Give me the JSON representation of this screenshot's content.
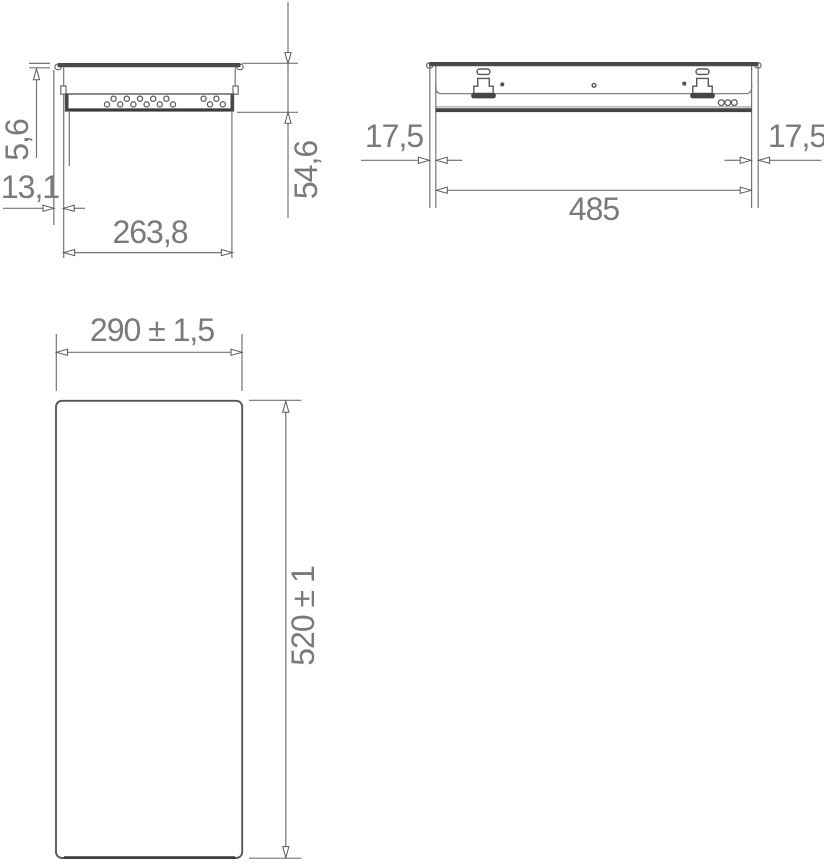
{
  "views": {
    "side_section": {
      "dims": {
        "flange_thickness": "5,6",
        "flange_overhang": "13,1",
        "body_width": "263,8",
        "recess_depth": "54,6"
      },
      "perforation": {
        "group1_count": 11,
        "group2_count": 4
      }
    },
    "front_elevation": {
      "dims": {
        "left_margin": "17,5",
        "cutout_width": "485",
        "right_margin": "17,5"
      },
      "vent_hole_count": 3
    },
    "plan_cutout": {
      "dims": {
        "width": "290 ± 1,5",
        "height": "520 ± 1"
      }
    }
  },
  "colors": {
    "background": "#ffffff",
    "line": "#747474",
    "dark_fill": "#4a4a4a",
    "text": "#7a7a7a"
  }
}
